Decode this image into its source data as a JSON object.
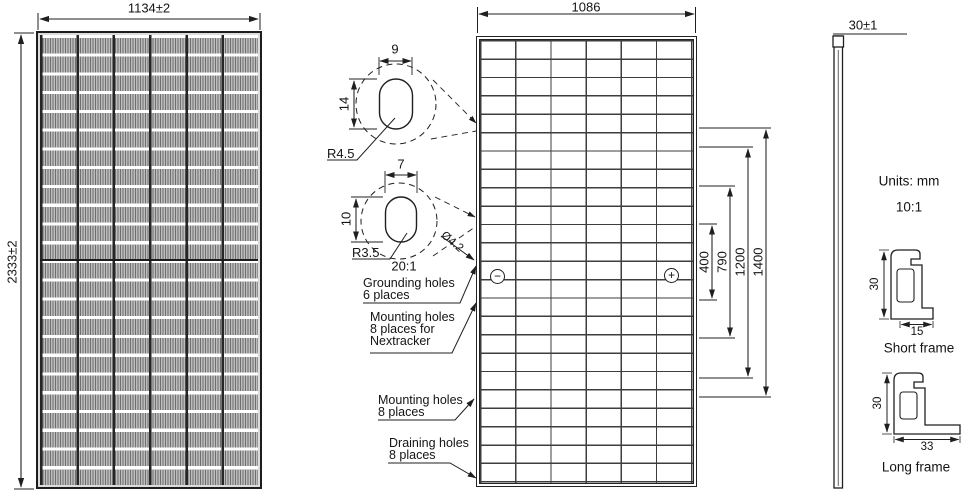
{
  "front_view": {
    "width_dim": "1134±2",
    "height_dim": "2333±2",
    "grid": {
      "columns": 6,
      "rows": 24
    }
  },
  "detail_top": {
    "slot_width_dim": "9",
    "slot_height_dim": "14",
    "corner_radius_label": "R4.5"
  },
  "detail_bottom": {
    "slot_width_dim": "7",
    "slot_height_dim": "10",
    "corner_radius_label": "R3.5",
    "scale_label": "20:1",
    "hole_diameter_label": "Ø4.2"
  },
  "back_view": {
    "width_dim": "1086",
    "grid": {
      "columns": 6,
      "rows": 24
    },
    "polarity": {
      "negative": "−",
      "positive": "+"
    },
    "span_dims": [
      "400",
      "790",
      "1200",
      "1400"
    ],
    "callouts": {
      "grounding": {
        "line1": "Grounding holes",
        "line2": "6 places"
      },
      "mounting_nextracker": {
        "line1": "Mounting holes",
        "line2": "8 places for",
        "line3": "Nextracker"
      },
      "mounting": {
        "line1": "Mounting holes",
        "line2": "8 places"
      },
      "draining": {
        "line1": "Draining holes",
        "line2": "8 places"
      }
    }
  },
  "side_view": {
    "thickness_dim": "30±1",
    "units_label": "Units: mm",
    "scale_label": "10:1",
    "short_frame": {
      "height_dim": "30",
      "width_dim": "15",
      "label": "Short frame"
    },
    "long_frame": {
      "height_dim": "30",
      "width_dim": "33",
      "label": "Long frame"
    }
  }
}
